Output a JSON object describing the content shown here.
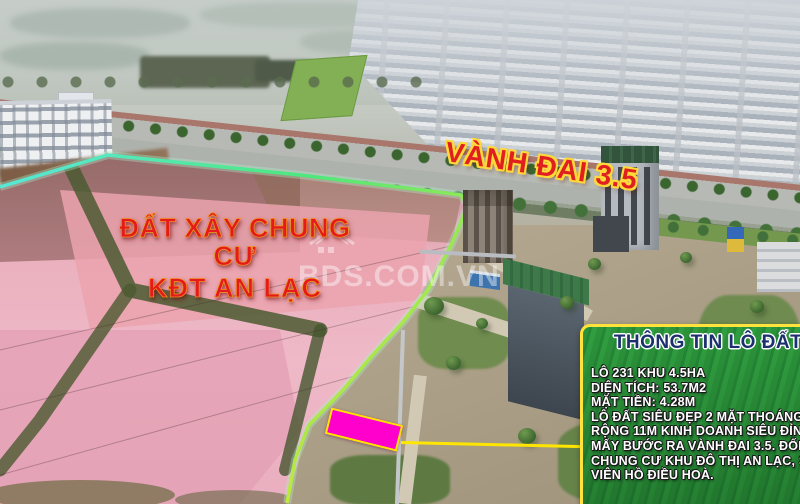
{
  "labels": {
    "land_overlay": {
      "line1": "ĐẤT  XÂY CHUNG CƯ",
      "line2": "KĐT AN LẠC"
    },
    "road": "VÀNH ĐAI 3.5",
    "watermark": "BDS.COM.VN"
  },
  "info_box": {
    "title": "THÔNG TIN LÔ ĐẤT",
    "lines": [
      "LÔ 231 KHU 4.5HA",
      "DIỆN TÍCH: 53.7M2",
      "MẶT TIỀN: 4.28M",
      "LÔ ĐẤT SIÊU ĐẸP 2 MẶT THOÁNG, ĐƯ",
      "RỘNG 11M KINH DOANH SIÊU ĐỈNH.",
      "MẤY BƯỚC RA VÀNH ĐAI 3.5. ĐỐI DI",
      "CHUNG CƯ KHU ĐÔ THỊ AN LẠC, SÁT",
      "VIÊN HỒ ĐIỀU HOÀ."
    ]
  },
  "markers": {
    "plot_fill": "#ff00cc",
    "plot_border": "#ffe600",
    "leader_color": "#ffe600",
    "boundary_start": "#57e8de",
    "boundary_mid": "#4ee87a",
    "boundary_end": "#c9e83a",
    "label_red": "#e51a1a",
    "label_outline": "#ffd83a",
    "info_border": "#ffe23c",
    "info_green": "#2f9e3f",
    "info_title_color": "#1c2f6e"
  }
}
